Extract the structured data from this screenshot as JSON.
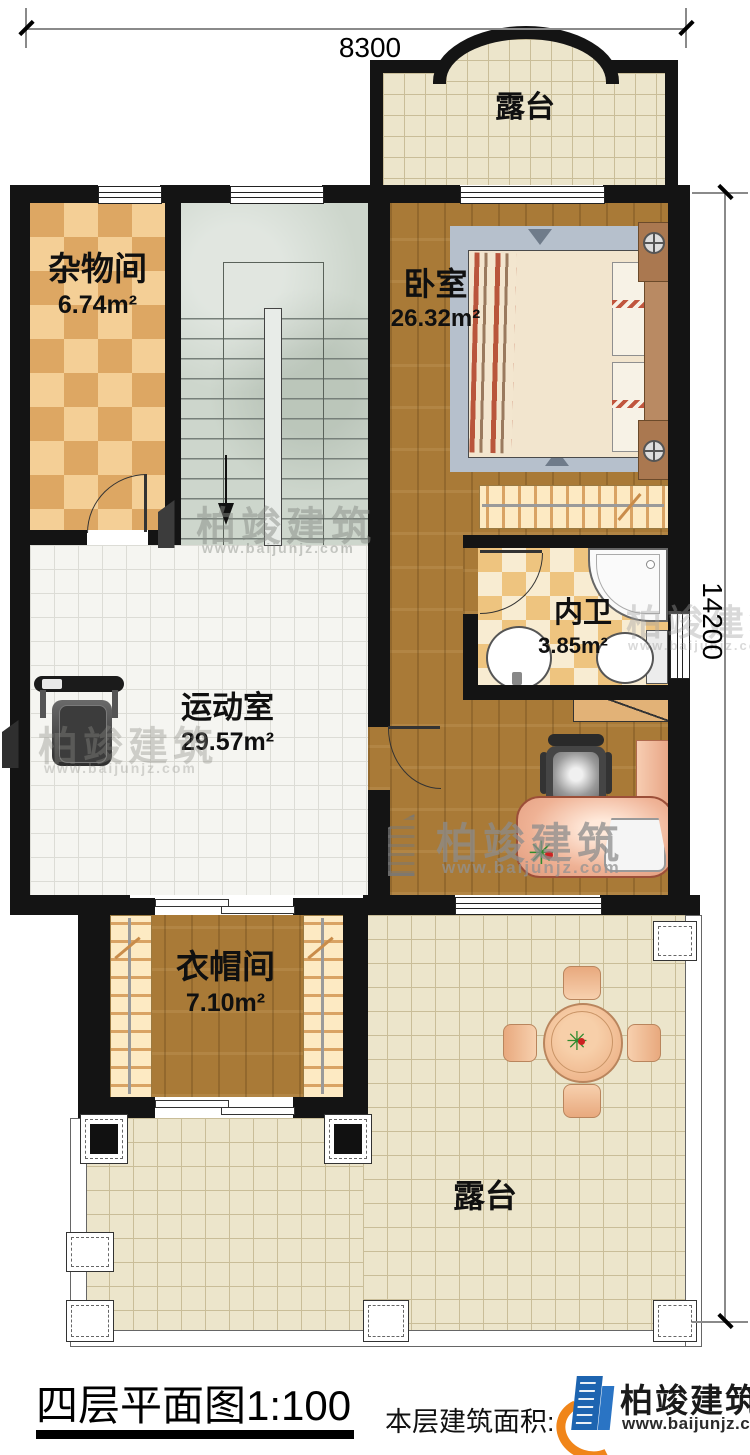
{
  "dimensions": {
    "top": "8300",
    "right": "14200"
  },
  "rooms": {
    "terrace_top": {
      "name": "露台"
    },
    "storage": {
      "name": "杂物间",
      "area": "6.74m²"
    },
    "bedroom": {
      "name": "卧室",
      "area": "26.32m²"
    },
    "bathroom": {
      "name": "内卫",
      "area": "3.85m²"
    },
    "gym": {
      "name": "运动室",
      "area": "29.57m²"
    },
    "cloakroom": {
      "name": "衣帽间",
      "area": "7.10m²"
    },
    "terrace_bottom": {
      "name": "露台"
    }
  },
  "footer": {
    "title": "四层平面图1:100",
    "area_note": "本层建筑面积:("
  },
  "brand": {
    "name": "柏竣建筑",
    "url": "www.baijunjz.com"
  },
  "watermark": {
    "name": "柏竣建筑",
    "url": "www.baijunjz.com"
  },
  "colors": {
    "wall": "#141414",
    "wood": "#a97a37",
    "terrace_tile": "#ece5cb",
    "gym_tile": "#f5f5f1",
    "checker_light": "#f4cf96",
    "checker_dark": "#dda763",
    "stairs": "#cdd6cc",
    "desk_salmon": "#eeab8d",
    "logo_blue": "#1d64b0",
    "logo_orange": "#f08519"
  }
}
